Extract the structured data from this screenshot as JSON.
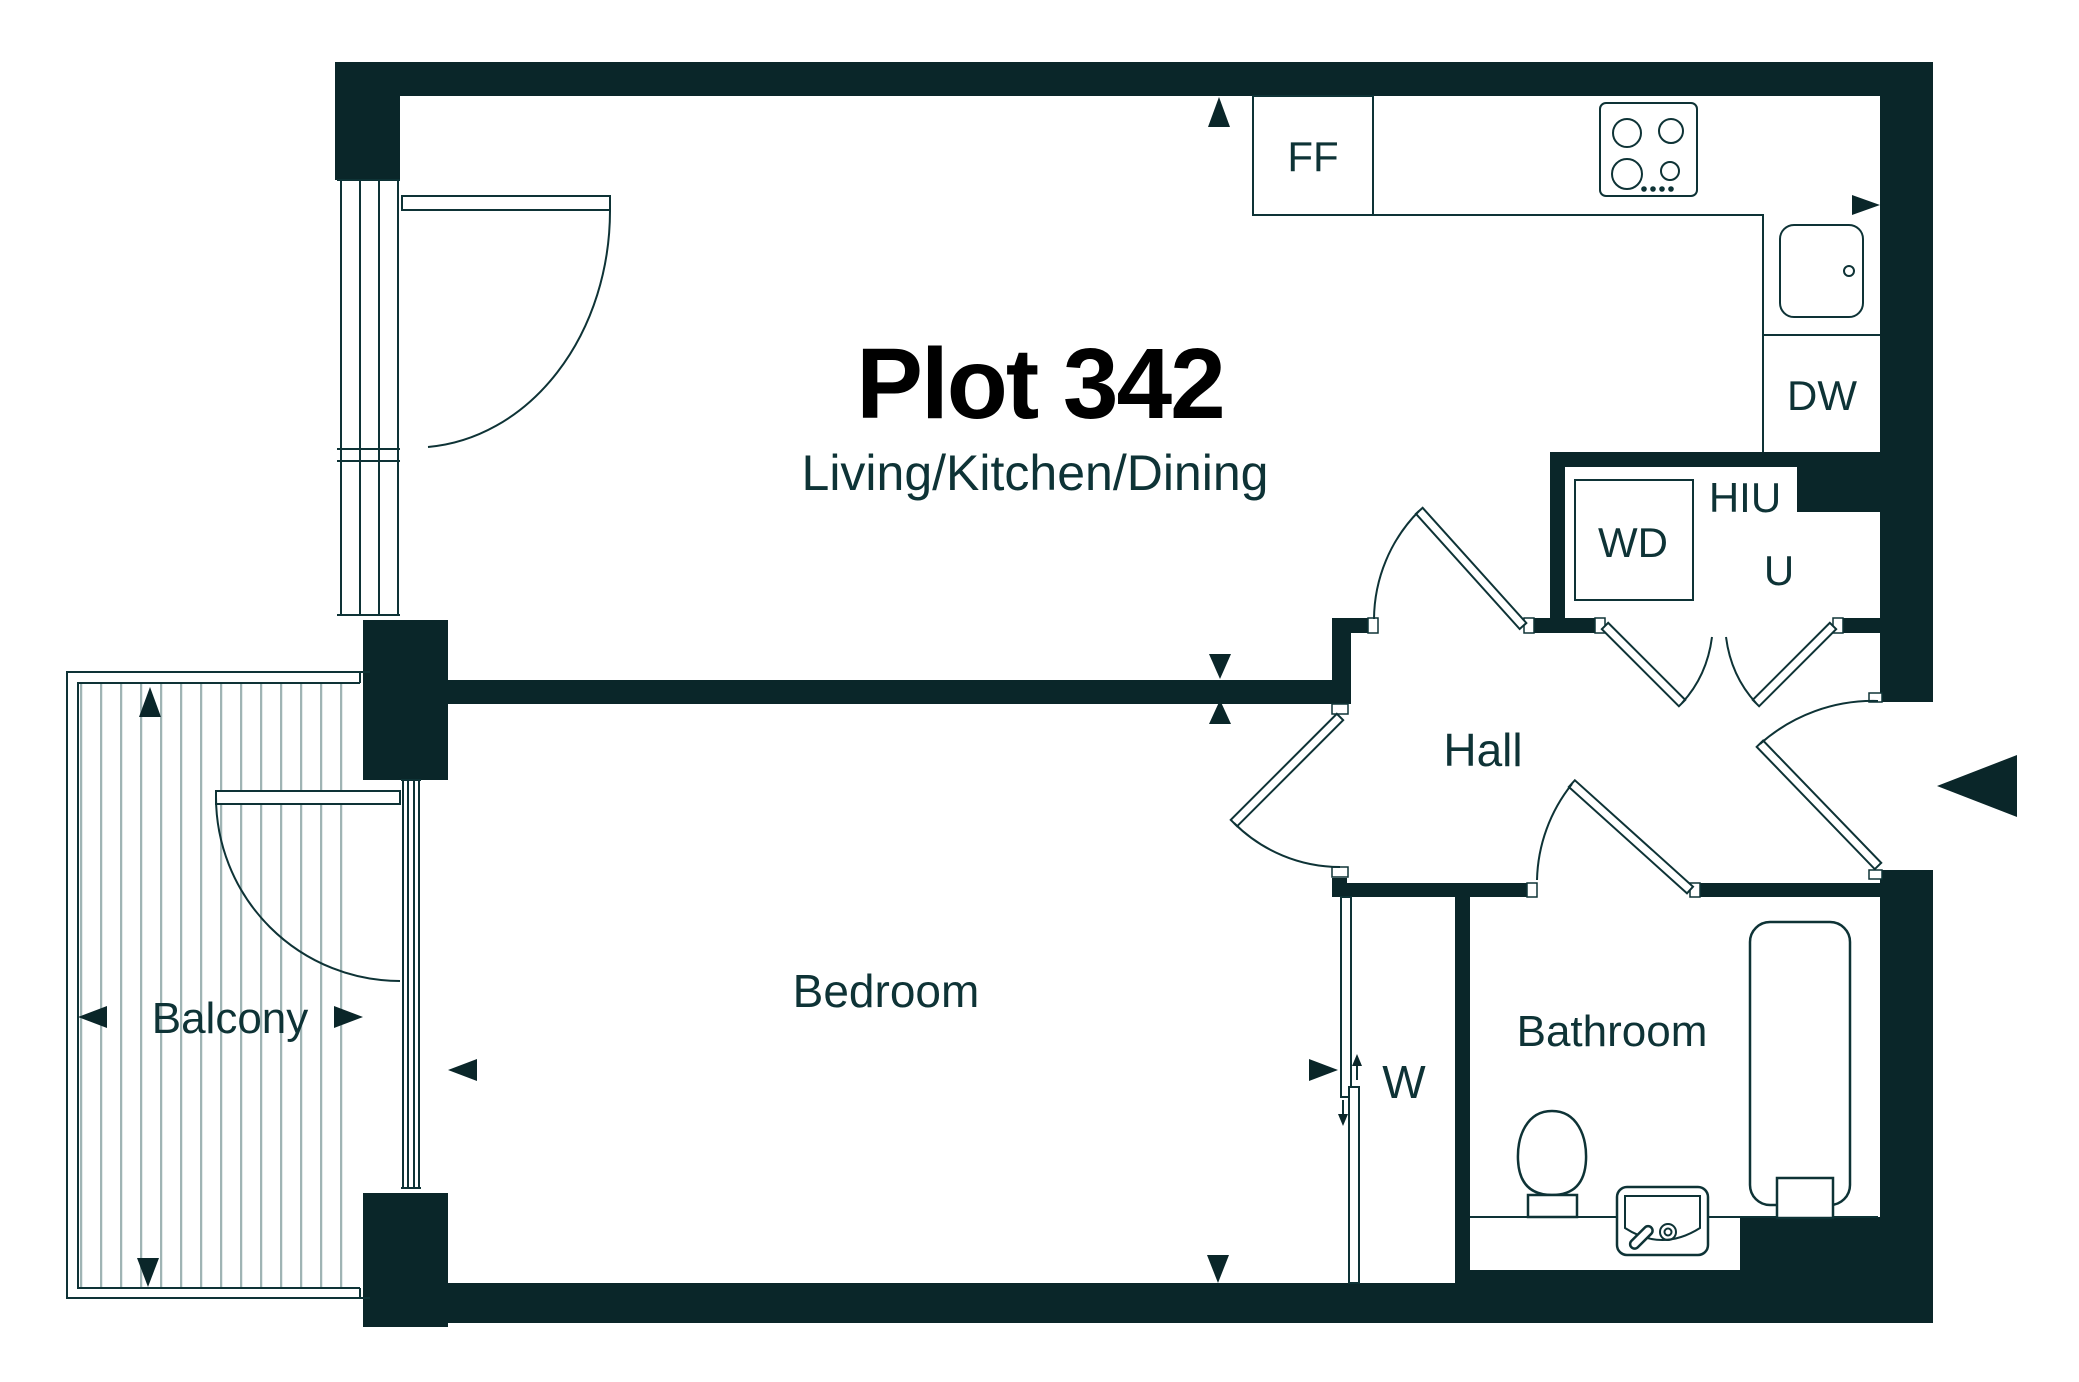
{
  "title": "Plot 342",
  "subtitle": "Living/Kitchen/Dining",
  "rooms": {
    "hall": "Hall",
    "bedroom": "Bedroom",
    "bathroom": "Bathroom",
    "balcony": "Balcony"
  },
  "fixtures": {
    "fridge_freezer": "FF",
    "dishwasher": "DW",
    "washer_dryer": "WD",
    "heat_interface_unit": "HIU",
    "utility_cupboard": "U",
    "wardrobe": "W"
  },
  "icons": {
    "entrance-arrow-icon": "solid triangle pointing left at entrance door",
    "dimension-arrow-icon": "small solid triangles marking measurement points",
    "slide-direction-arrow-icon": "small thin arrows on wardrobe sliding doors"
  },
  "colors": {
    "wall": "#0a2629",
    "ink": "#0e3336",
    "title": "#000000",
    "stripe": "#9fb4b4",
    "bg": "#ffffff"
  }
}
